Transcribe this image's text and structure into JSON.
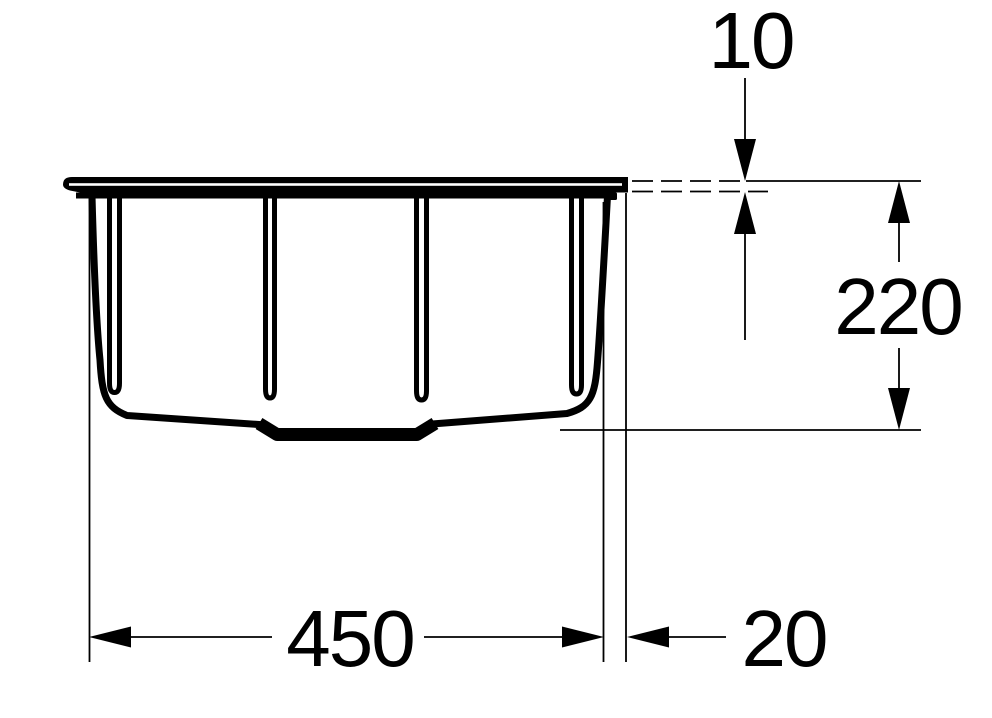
{
  "drawing": {
    "subject": "sink-bowl-side-elevation-technical-drawing",
    "background_color": "#ffffff",
    "line_color": "#000000",
    "dimensions": {
      "rim_thickness": {
        "value": "10",
        "orientation": "vertical",
        "location": "top-right"
      },
      "bowl_depth": {
        "value": "220",
        "orientation": "vertical",
        "location": "right"
      },
      "bowl_width": {
        "value": "450",
        "orientation": "horizontal",
        "location": "bottom"
      },
      "rim_overhang": {
        "value": "20",
        "orientation": "horizontal",
        "location": "bottom-right"
      }
    }
  }
}
